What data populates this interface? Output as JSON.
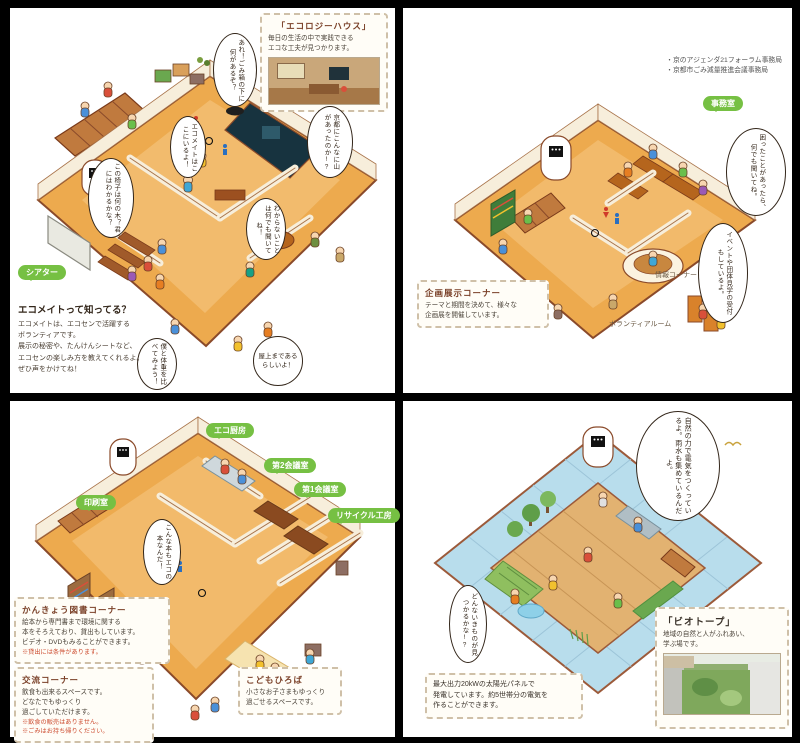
{
  "colors": {
    "label_green": "#76c043",
    "floor_orange": "#edaa4e",
    "wall_cream": "#f7eedb",
    "outline_brown": "#8a4a2a",
    "solar_blue": "#b8ddec",
    "deck_wood": "#e2b271",
    "note_red": "#cc4a2e"
  },
  "floor1": {
    "eco_house_box": {
      "title": "「エコロジーハウス」",
      "line1": "毎日の生活の中で実践できる",
      "line2": "エコな工夫が見つかります。"
    },
    "bubbles": {
      "trash": "あれ！ごみ箱の下に何があるぞ？",
      "kyoto": "京都にこんなに山があったのか!?",
      "chair": "この椅子は何の木？君にはわかるかな？",
      "ecomate": "エコメイトはここにいるよ！",
      "ask": "わからないことは何でも聞いてね！",
      "weight": "僕と体重を比べてみよう！",
      "rooftop": "屋上まであるらしいよ！"
    },
    "labels": {
      "theater": "シアター"
    },
    "note": {
      "title": "エコメイトって知ってる？",
      "lines": [
        "エコメイトは、エコセンで活躍する",
        "ボランティアです。",
        "展示の秘密や、たんけんシートなど、",
        "エコセンの楽しみ方を教えてくれるよ。",
        "ぜひ声をかけてね！"
      ]
    }
  },
  "floor2": {
    "offices": [
      "・京のアジェンダ21フォーラム事務局",
      "・京都市ごみ減量推進会議事務局"
    ],
    "labels": {
      "office": "事務室",
      "info_corner": "情報コーナー",
      "volunteer_room": "ボランティアルーム"
    },
    "bubbles": {
      "trouble": "困ったことがあったら、何でも聞いてね。",
      "events": "イベントや団体見学の受付もしているよ。"
    },
    "exhibit_box": {
      "title": "企画展示コーナー",
      "lines": [
        "テーマと期間を決めて、様々な",
        "企画展を開催しています。"
      ]
    }
  },
  "floor3": {
    "labels": {
      "print_room": "印刷室",
      "eco_kitchen": "エコ厨房",
      "meeting2": "第2会議室",
      "meeting1": "第1会議室",
      "recycle": "リサイクル工房"
    },
    "bubbles": {
      "book": "こんな本もエコの本なんだ！"
    },
    "library_box": {
      "title": "かんきょう図書コーナー",
      "lines": [
        "絵本から専門書まで環境に関する",
        "本をそろえており、貸出もしています。",
        "ビデオ・DVDもみることができます。"
      ],
      "note": "※貸出には条件があります。"
    },
    "exchange_box": {
      "title": "交流コーナー",
      "lines": [
        "飲食も出来るスペースです。",
        "どなたでもゆっくり",
        "過ごしていただけます。"
      ],
      "notes": [
        "※飲食の販売はありません。",
        "※ごみはお持ち帰りください。"
      ]
    },
    "kids_box": {
      "title": "こどもひろば",
      "lines": [
        "小さなお子さまもゆっくり",
        "過ごせるスペースです。"
      ]
    }
  },
  "rooftop": {
    "bubbles": {
      "nature": "自然の力で電気をつくっているよ。雨水も集めているんだよ。",
      "creatures": "どんないきものが見つかるかな!?"
    },
    "solar_box": {
      "lines": [
        "最大出力20kWの太陽光パネルで",
        "発電しています。約5世帯分の電気を",
        "作ることができます。"
      ]
    },
    "biotope_box": {
      "title": "「ビオトープ」",
      "lines": [
        "地域の自然と人がふれあい、",
        "学ぶ場です。"
      ]
    }
  }
}
